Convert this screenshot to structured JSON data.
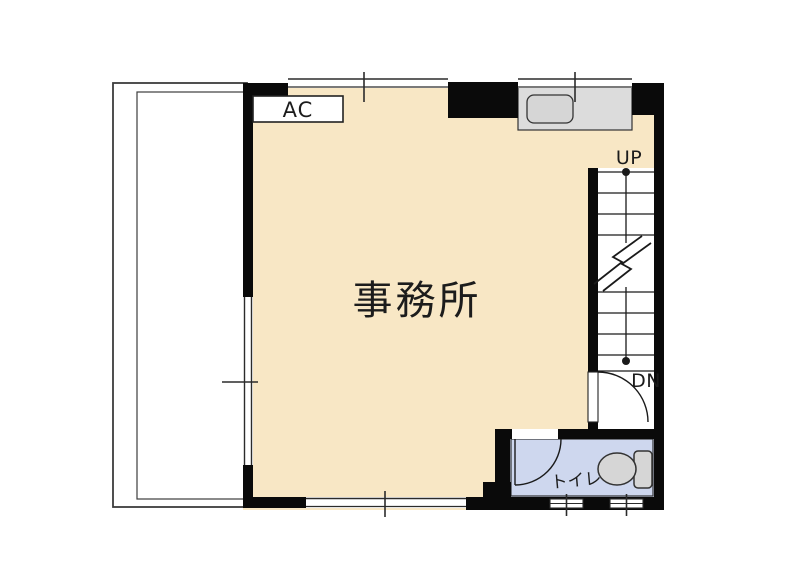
{
  "type": "floor_plan",
  "palette": {
    "office_fill": "#F8E7C5",
    "toilet_fill": "#CED7EE",
    "counter_fill": "#DCDCDC",
    "fixture_fill": "#D6D6D6",
    "wall": "#0A0A0A",
    "line": "#2B2B2B",
    "background": "#FFFFFF"
  },
  "labels": {
    "ac_unit": "AC",
    "office": "事務所",
    "stairs_up": "UP",
    "stairs_down": "DN",
    "toilet": "トイレ"
  }
}
